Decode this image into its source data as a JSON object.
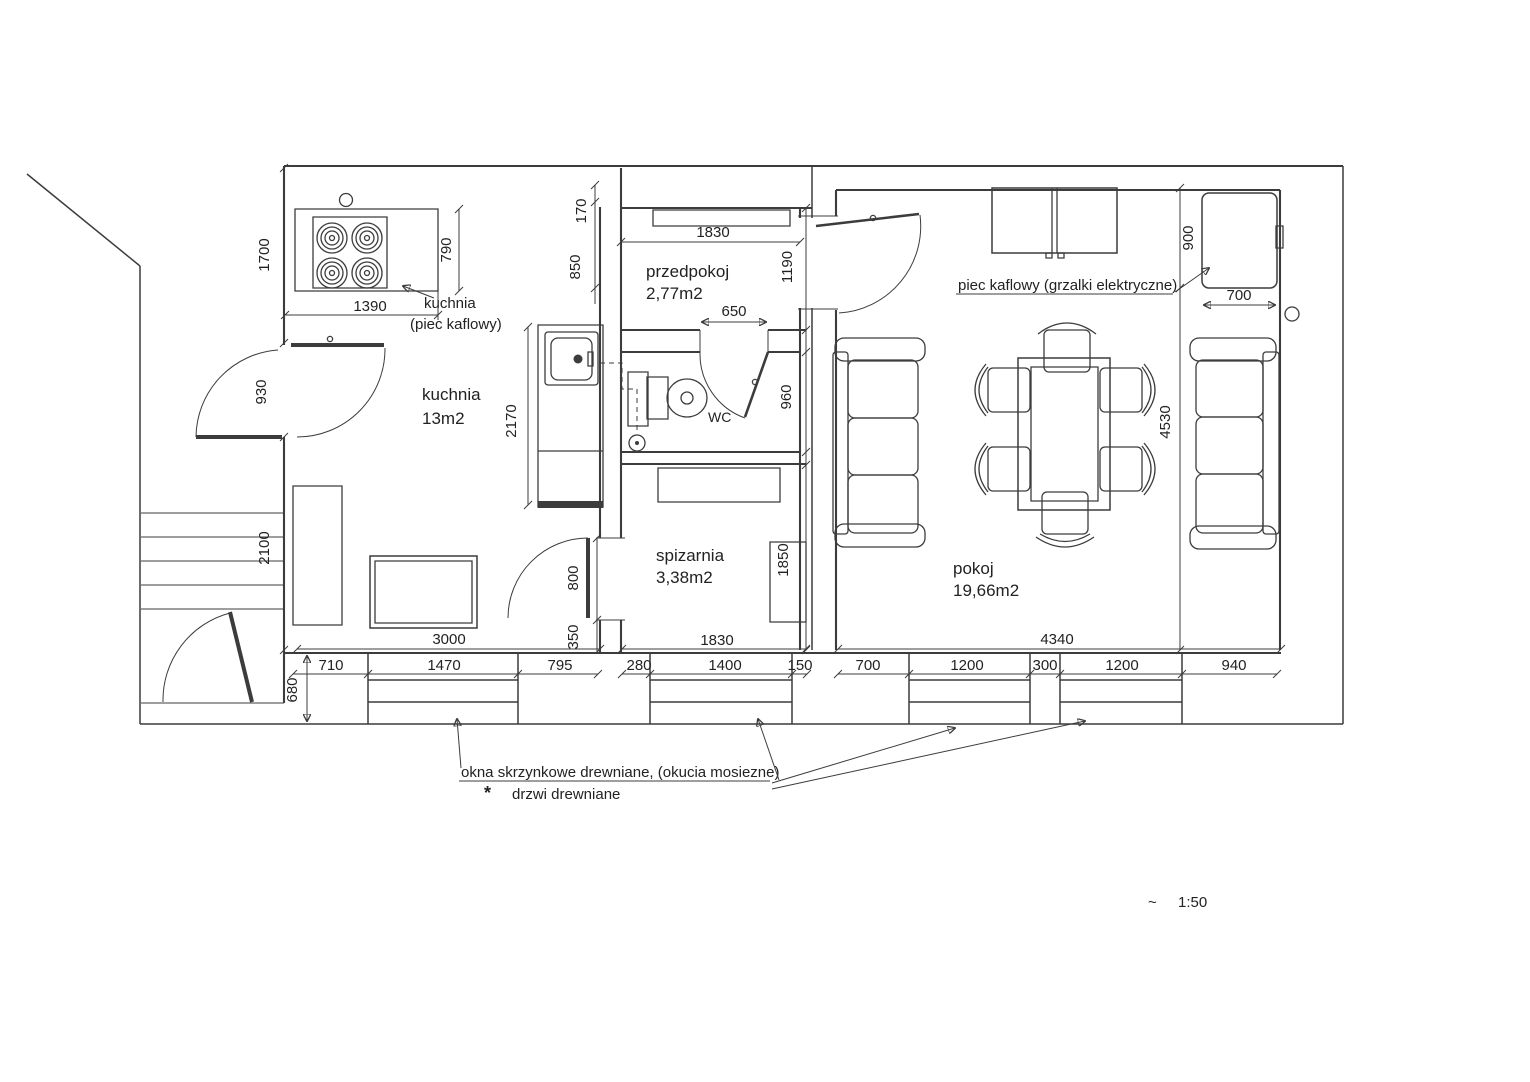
{
  "rooms": [
    {
      "id": "kuchnia",
      "name": "kuchnia",
      "area": "13m2"
    },
    {
      "id": "przedpokoj",
      "name": "przedpokoj",
      "area": "2,77m2"
    },
    {
      "id": "spizarnia",
      "name": "spizarnia",
      "area": "3,38m2"
    },
    {
      "id": "wc",
      "name": "WC"
    },
    {
      "id": "pokoj",
      "name": "pokoj",
      "area": "19,66m2"
    }
  ],
  "annotations": {
    "stove_label_line1": "kuchnia",
    "stove_label_line2": "(piec kaflowy)",
    "tiled_stove_note": "piec kaflowy (grzalki elektryczne)",
    "windows_note": "okna skrzynkowe drewniane, (okucia mosiezne)",
    "doors_note": "drzwi drewniane",
    "door_marker": "*",
    "scale_approx": "~",
    "scale_value": "1:50"
  },
  "dimensions": {
    "wall_left_upper": "1700",
    "stove_depth": "790",
    "gap_170": "170",
    "gap_850": "850",
    "stove_width": "1390",
    "door_left": "930",
    "stairs_2100": "2100",
    "counter_2170": "2170",
    "przedpokoj_width": "1830",
    "przedpokoj_depth": "1190",
    "wc_door": "650",
    "wc_depth": "960",
    "stove_right_depth": "900",
    "stove_right_width": "700",
    "pokoj_depth": "4530",
    "spizarnia_door": "800",
    "door_offset": "350",
    "spizarnia_depth": "1850",
    "kuchnia_width": "3000",
    "spizarnia_width": "1830",
    "pokoj_width": "4340",
    "wall_bottom_680": "680",
    "seg_710": "710",
    "window_kitchen": "1470",
    "seg_795": "795",
    "seg_280": "280",
    "window_spizarnia": "1400",
    "seg_150": "150",
    "seg_700": "700",
    "window_pokoj_1": "1200",
    "pier_300": "300",
    "window_pokoj_2": "1200",
    "seg_940": "940"
  },
  "colors": {
    "line": "#3c3c3c",
    "red_marker": "#a83232",
    "window_line": "#4a4a5c",
    "plumbing_dash": "#c9b88e"
  }
}
